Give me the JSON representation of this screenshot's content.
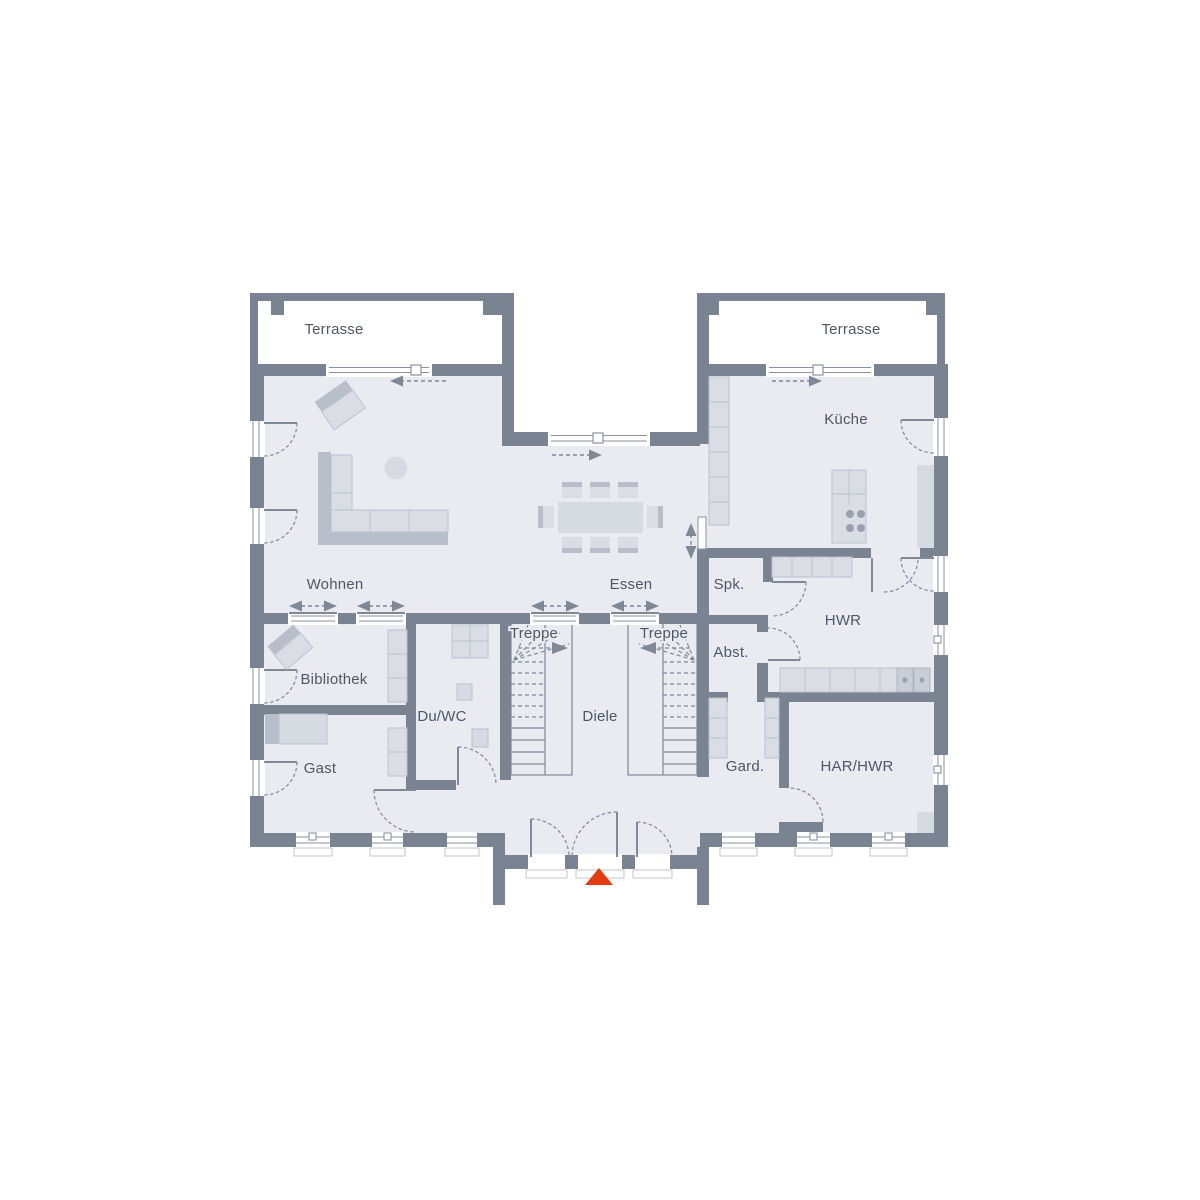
{
  "title": "Erdgeschoss Grundriss",
  "rooms": {
    "terrasse_left": "Terrasse",
    "terrasse_right": "Terrasse",
    "wohnen": "Wohnen",
    "essen": "Essen",
    "kueche": "Küche",
    "spk": "Spk.",
    "hwr": "HWR",
    "abst": "Abst.",
    "bibliothek": "Bibliothek",
    "gast": "Gast",
    "duwc": "Du/WC",
    "treppe_left": "Treppe",
    "treppe_right": "Treppe",
    "diele": "Diele",
    "gard": "Gard.",
    "har_hwr": "HAR/HWR"
  },
  "colors": {
    "wall": "#7a8391",
    "floor": "#e9ebf1",
    "furniture": "#dadde4",
    "furniture_dark": "#b9bfca",
    "label": "#4e5765",
    "entrance_marker": "#e63b0e"
  },
  "icons": {
    "entrance_marker": "red-triangle-entrance-arrow"
  }
}
